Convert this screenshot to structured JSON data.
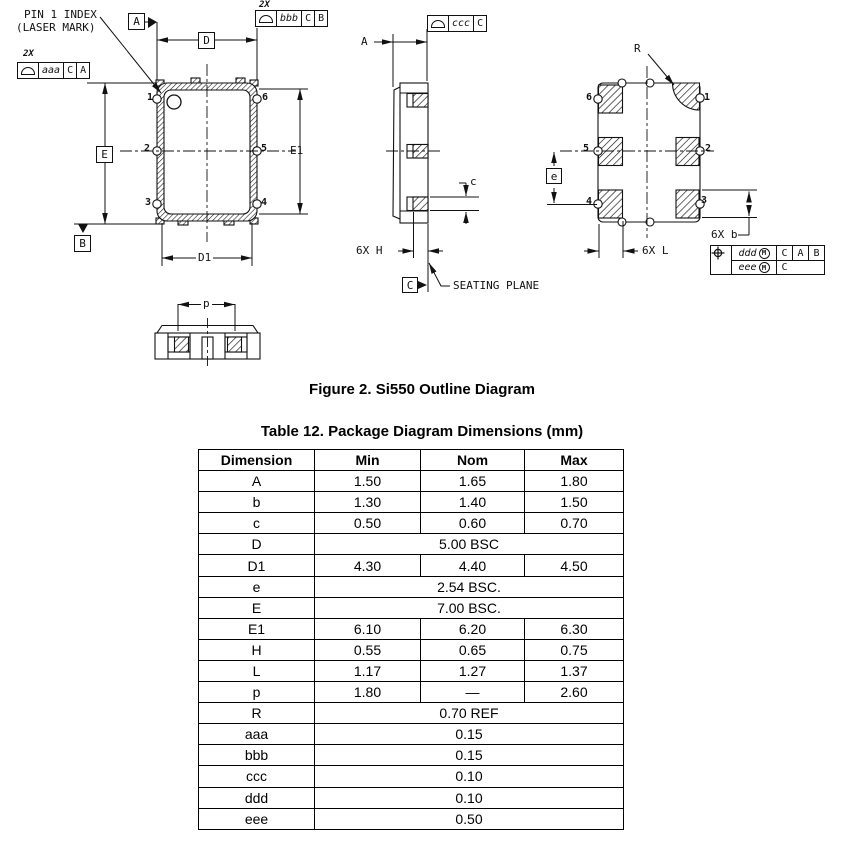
{
  "figure": {
    "caption": "Figure 2. Si550 Outline Diagram"
  },
  "diagram": {
    "pin1_note_line1": "PIN 1 INDEX",
    "pin1_note_line2": "(LASER MARK)",
    "seating_plane": "SEATING PLANE",
    "dim_labels": {
      "D": "D",
      "E": "E",
      "E1": "E1",
      "D1": "D1",
      "A": "A",
      "c": "c",
      "e": "e",
      "p": "p",
      "R": "R"
    },
    "count_labels": {
      "H": "6X H",
      "L": "6X L",
      "b": "6X b"
    },
    "datum_labels": {
      "A": "A",
      "B": "B",
      "C": "C"
    },
    "front_view": {
      "pins_left": [
        "1",
        "2",
        "3"
      ],
      "pins_right": [
        "6",
        "5",
        "4"
      ]
    },
    "back_view": {
      "pins_left": [
        "6",
        "5",
        "4"
      ],
      "pins_right": [
        "1",
        "2",
        "3"
      ]
    },
    "fcf_aaa": {
      "qty": "2X",
      "tol": "aaa",
      "ref1": "C",
      "ref2": "A"
    },
    "fcf_bbb": {
      "qty": "2X",
      "tol": "bbb",
      "ref1": "C",
      "ref2": "B"
    },
    "fcf_ccc": {
      "tol": "ccc",
      "ref1": "C"
    },
    "fcf_position": {
      "row1": {
        "tol": "ddd",
        "mod": "M",
        "ref1": "C",
        "ref2": "A",
        "ref3": "B"
      },
      "row2": {
        "tol": "eee",
        "mod": "M",
        "ref1": "C"
      }
    }
  },
  "table": {
    "title": "Table 12. Package Diagram Dimensions (mm)",
    "headers": [
      "Dimension",
      "Min",
      "Nom",
      "Max"
    ],
    "rows": [
      {
        "dim": "A",
        "min": "1.50",
        "nom": "1.65",
        "max": "1.80"
      },
      {
        "dim": "b",
        "min": "1.30",
        "nom": "1.40",
        "max": "1.50"
      },
      {
        "dim": "c",
        "min": "0.50",
        "nom": "0.60",
        "max": "0.70"
      },
      {
        "dim": "D",
        "span": "5.00 BSC"
      },
      {
        "dim": "D1",
        "min": "4.30",
        "nom": "4.40",
        "max": "4.50"
      },
      {
        "dim": "e",
        "span": "2.54 BSC."
      },
      {
        "dim": "E",
        "span": "7.00 BSC."
      },
      {
        "dim": "E1",
        "min": "6.10",
        "nom": "6.20",
        "max": "6.30"
      },
      {
        "dim": "H",
        "min": "0.55",
        "nom": "0.65",
        "max": "0.75"
      },
      {
        "dim": "L",
        "min": "1.17",
        "nom": "1.27",
        "max": "1.37"
      },
      {
        "dim": "p",
        "min": "1.80",
        "nom": "—",
        "max": "2.60"
      },
      {
        "dim": "R",
        "span": "0.70 REF"
      },
      {
        "dim": "aaa",
        "span": "0.15"
      },
      {
        "dim": "bbb",
        "span": "0.15"
      },
      {
        "dim": "ccc",
        "span": "0.10"
      },
      {
        "dim": "ddd",
        "span": "0.10"
      },
      {
        "dim": "eee",
        "span": "0.50"
      }
    ]
  }
}
